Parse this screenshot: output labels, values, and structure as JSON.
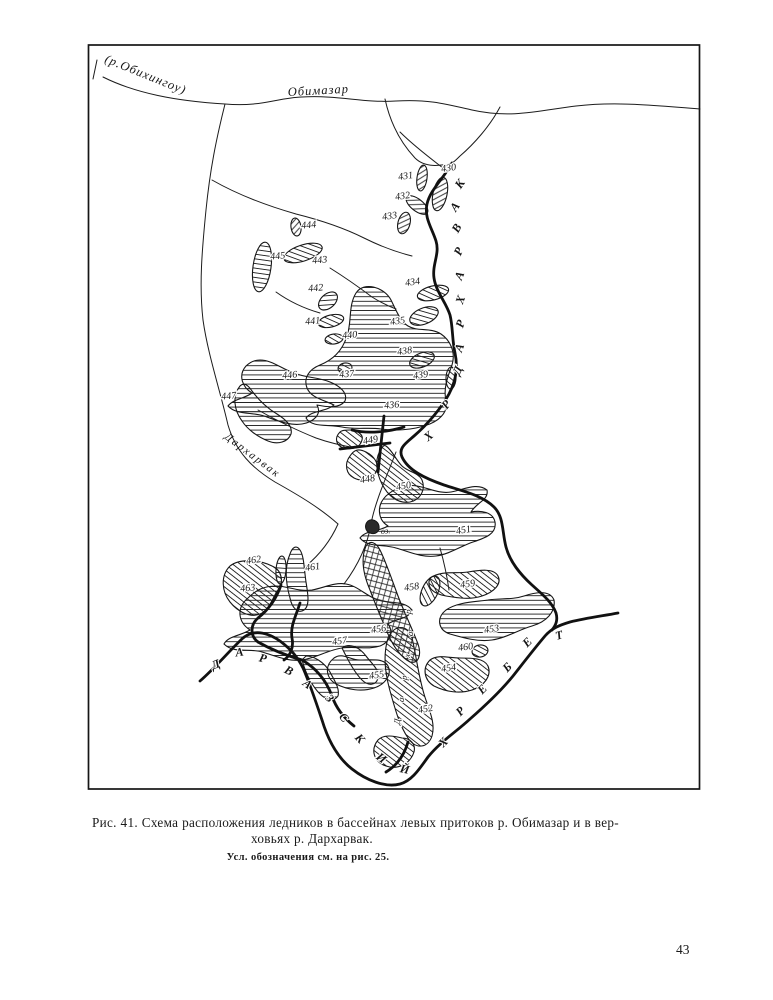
{
  "figure": {
    "caption_line1": "Рис. 41. Схема расположения ледников в бассейнах левых притоков р. Обимазар и в вер-",
    "caption_line2": "ховьях р. Дархарвак.",
    "note": "Усл. обозначения см. на рис. 25."
  },
  "page": {
    "number": "43"
  },
  "map": {
    "labels": {
      "obikhingou": "(р.Обихингоу)",
      "obimazar": "Обимазар",
      "darkharvak_river": "Дархарвак",
      "lake": "оз."
    },
    "glaciers": [
      {
        "n": "430",
        "x": 449,
        "y": 171,
        "r": -8
      },
      {
        "n": "431",
        "x": 406,
        "y": 179,
        "r": -8
      },
      {
        "n": "432",
        "x": 403,
        "y": 199,
        "r": -8
      },
      {
        "n": "433",
        "x": 390,
        "y": 219,
        "r": -8
      },
      {
        "n": "444",
        "x": 309,
        "y": 228,
        "r": -5
      },
      {
        "n": "445",
        "x": 278,
        "y": 259,
        "r": -5
      },
      {
        "n": "443",
        "x": 320,
        "y": 263,
        "r": -5
      },
      {
        "n": "442",
        "x": 316,
        "y": 291,
        "r": -5
      },
      {
        "n": "434",
        "x": 413,
        "y": 285,
        "r": -8
      },
      {
        "n": "441",
        "x": 313,
        "y": 324,
        "r": -5
      },
      {
        "n": "440",
        "x": 350,
        "y": 338,
        "r": -5
      },
      {
        "n": "435",
        "x": 398,
        "y": 324,
        "r": -8
      },
      {
        "n": "438",
        "x": 405,
        "y": 354,
        "r": -8
      },
      {
        "n": "437",
        "x": 347,
        "y": 377,
        "r": -5
      },
      {
        "n": "446",
        "x": 290,
        "y": 378,
        "r": -5
      },
      {
        "n": "439",
        "x": 421,
        "y": 378,
        "r": -8
      },
      {
        "n": "447",
        "x": 229,
        "y": 399,
        "r": -5
      },
      {
        "n": "436",
        "x": 392,
        "y": 408,
        "r": -5
      },
      {
        "n": "449",
        "x": 371,
        "y": 443,
        "r": -10
      },
      {
        "n": "448",
        "x": 368,
        "y": 482,
        "r": -10
      },
      {
        "n": "450",
        "x": 404,
        "y": 489,
        "r": -10
      },
      {
        "n": "451",
        "x": 464,
        "y": 533,
        "r": -10
      },
      {
        "n": "462",
        "x": 254,
        "y": 563,
        "r": -8
      },
      {
        "n": "461",
        "x": 313,
        "y": 570,
        "r": -8
      },
      {
        "n": "463",
        "x": 248,
        "y": 591,
        "r": -5
      },
      {
        "n": "458",
        "x": 412,
        "y": 590,
        "r": -8
      },
      {
        "n": "459",
        "x": 468,
        "y": 587,
        "r": -8
      },
      {
        "n": "456",
        "x": 379,
        "y": 632,
        "r": -8
      },
      {
        "n": "457",
        "x": 340,
        "y": 644,
        "r": -8
      },
      {
        "n": "453",
        "x": 492,
        "y": 632,
        "r": -8
      },
      {
        "n": "460",
        "x": 466,
        "y": 650,
        "r": -8
      },
      {
        "n": "454",
        "x": 449,
        "y": 671,
        "r": -8
      },
      {
        "n": "455",
        "x": 377,
        "y": 678,
        "r": -8
      },
      {
        "n": "452",
        "x": 426,
        "y": 712,
        "r": -10
      }
    ],
    "ridge_right": {
      "name": "хр. Дархарвак",
      "letters": [
        {
          "ch": "К",
          "x": 463,
          "y": 186,
          "r": -55
        },
        {
          "ch": "А",
          "x": 458,
          "y": 209,
          "r": -55
        },
        {
          "ch": "В",
          "x": 460,
          "y": 230,
          "r": -60
        },
        {
          "ch": "Р",
          "x": 462,
          "y": 253,
          "r": -65
        },
        {
          "ch": "А",
          "x": 463,
          "y": 277,
          "r": -68
        },
        {
          "ch": "Х",
          "x": 464,
          "y": 301,
          "r": -70
        },
        {
          "ch": "Р",
          "x": 464,
          "y": 325,
          "r": -72
        },
        {
          "ch": "А",
          "x": 463,
          "y": 349,
          "r": -70
        },
        {
          "ch": "Д",
          "x": 461,
          "y": 372,
          "r": -65
        },
        {
          "ch": "Р",
          "x": 449,
          "y": 407,
          "r": -50
        },
        {
          "ch": "Х",
          "x": 431,
          "y": 439,
          "r": -40
        }
      ]
    },
    "ridge_bottom_left": {
      "name": "Дарвазский",
      "letters": [
        {
          "ch": "Д",
          "x": 217,
          "y": 668,
          "r": -22
        },
        {
          "ch": "А",
          "x": 240,
          "y": 656,
          "r": -8
        },
        {
          "ch": "Р",
          "x": 262,
          "y": 662,
          "r": 14
        },
        {
          "ch": "В",
          "x": 287,
          "y": 674,
          "r": 28
        },
        {
          "ch": "А",
          "x": 305,
          "y": 687,
          "r": 38
        },
        {
          "ch": "З",
          "x": 327,
          "y": 701,
          "r": 45
        },
        {
          "ch": "С",
          "x": 341,
          "y": 720,
          "r": 50
        },
        {
          "ch": "К",
          "x": 357,
          "y": 741,
          "r": 48
        },
        {
          "ch": "И",
          "x": 379,
          "y": 761,
          "r": 38
        },
        {
          "ch": "Й",
          "x": 404,
          "y": 773,
          "r": 12
        }
      ]
    },
    "ridge_bottom_right": {
      "name": "хребет",
      "letters": [
        {
          "ch": "Х",
          "x": 446,
          "y": 745,
          "r": -45
        },
        {
          "ch": "Р",
          "x": 463,
          "y": 714,
          "r": -45
        },
        {
          "ch": "Е",
          "x": 485,
          "y": 692,
          "r": -45
        },
        {
          "ch": "Б",
          "x": 510,
          "y": 670,
          "r": -45
        },
        {
          "ch": "Е",
          "x": 530,
          "y": 645,
          "r": -45
        },
        {
          "ch": "Т",
          "x": 560,
          "y": 639,
          "r": -15
        }
      ]
    },
    "river_vertical": {
      "name": "Дархарвак",
      "letters": [
        {
          "ch": "Д",
          "x": 400,
          "y": 722,
          "r": -80
        },
        {
          "ch": "а",
          "x": 404,
          "y": 700,
          "r": -82
        },
        {
          "ch": "р",
          "x": 407,
          "y": 678,
          "r": -82
        },
        {
          "ch": "х",
          "x": 410,
          "y": 656,
          "r": -82
        },
        {
          "ch": "а",
          "x": 413,
          "y": 634,
          "r": -84
        },
        {
          "ch": "р",
          "x": 411,
          "y": 612,
          "r": -84
        }
      ]
    }
  }
}
